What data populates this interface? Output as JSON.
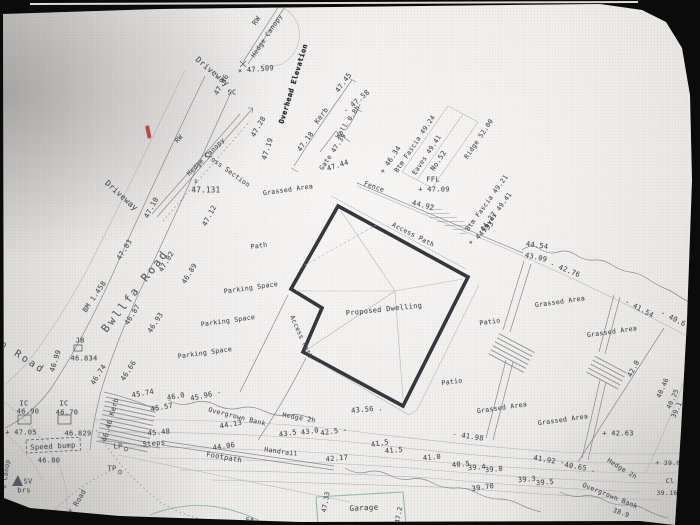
{
  "palette": {
    "background": "#0b0b0b",
    "paper": "#eae8e4",
    "ink": "#4d525a",
    "building_outline": "#34383e",
    "garage_teal": "#84b6ad",
    "pen_mark_red": "#b5332c"
  },
  "plan": {
    "building_label": "Proposed Dwelling",
    "road_name": "Bwllfa Road",
    "labels": [
      {
        "t": "Driveway",
        "x": 212,
        "y": 72,
        "r": 40,
        "s": 8
      },
      {
        "t": "RW",
        "x": 257,
        "y": 21,
        "r": -56,
        "s": 7
      },
      {
        "t": "Hedge Canopy",
        "x": 267,
        "y": 36,
        "r": -56,
        "s": 6.5
      },
      {
        "t": "× 47.509",
        "x": 256,
        "y": 70,
        "r": -5,
        "s": 7
      },
      {
        "t": "47.46",
        "x": 222,
        "y": 85,
        "r": -60,
        "s": 7
      },
      {
        "t": "SC",
        "x": 232,
        "y": 93,
        "r": 0,
        "s": 7
      },
      {
        "t": "Driveway",
        "x": 121,
        "y": 196,
        "r": 42,
        "s": 8
      },
      {
        "t": "47.10",
        "x": 152,
        "y": 208,
        "r": -62,
        "s": 7
      },
      {
        "t": "RW",
        "x": 179,
        "y": 139,
        "r": -48,
        "s": 6.5
      },
      {
        "t": "Hedge Canopy",
        "x": 206,
        "y": 157,
        "r": -45,
        "s": 6.5
      },
      {
        "t": "Cross Section",
        "x": 227,
        "y": 170,
        "r": 36,
        "s": 6.5
      },
      {
        "t": "s",
        "x": 196,
        "y": 182,
        "r": 0,
        "s": 6
      },
      {
        "t": "47.131",
        "x": 206,
        "y": 190,
        "r": 0,
        "s": 7.5
      },
      {
        "t": "47.12",
        "x": 210,
        "y": 216,
        "r": -62,
        "s": 7
      },
      {
        "t": "47.28",
        "x": 259,
        "y": 127,
        "r": -60,
        "s": 7
      },
      {
        "t": "47.19",
        "x": 268,
        "y": 149,
        "r": -72,
        "s": 7
      },
      {
        "t": "Overhead Elevation",
        "x": 294,
        "y": 84,
        "r": -73,
        "s": 7,
        "c": "bold",
        "n": "bold-annotation"
      },
      {
        "t": "47.18",
        "x": 306,
        "y": 142,
        "r": -54,
        "s": 7
      },
      {
        "t": "Kerb",
        "x": 322,
        "y": 116,
        "r": -54,
        "s": 7
      },
      {
        "t": "47.45",
        "x": 344,
        "y": 83,
        "r": -54,
        "s": 7
      },
      {
        "t": "Gate 47.39",
        "x": 333,
        "y": 152,
        "r": -56,
        "s": 6.5
      },
      {
        "t": "Wall 0.8h",
        "x": 348,
        "y": 122,
        "r": -56,
        "s": 6.5
      },
      {
        "t": "- 47.58",
        "x": 357,
        "y": 102,
        "r": -40,
        "s": 7
      },
      {
        "t": "47.44",
        "x": 338,
        "y": 166,
        "r": -18,
        "s": 7
      },
      {
        "t": "Grassed Area",
        "x": 288,
        "y": 190,
        "r": -8,
        "s": 6.5
      },
      {
        "t": "47.03",
        "x": 125,
        "y": 250,
        "r": -58,
        "s": 7
      },
      {
        "t": "47.02",
        "x": 167,
        "y": 262,
        "r": -58,
        "s": 7
      },
      {
        "t": "46.89",
        "x": 190,
        "y": 274,
        "r": -58,
        "s": 7
      },
      {
        "t": "Bwllfa Road",
        "x": 135,
        "y": 291,
        "r": -52,
        "s": 11,
        "c": "big",
        "n": "road-name-bwllfa"
      },
      {
        "t": "BM 1.458",
        "x": 95,
        "y": 297,
        "r": -56,
        "s": 7
      },
      {
        "t": "46.87",
        "x": 133,
        "y": 315,
        "r": -58,
        "s": 7
      },
      {
        "t": "46.93",
        "x": 156,
        "y": 323,
        "r": -58,
        "s": 7
      },
      {
        "t": "p Road",
        "x": 22,
        "y": 358,
        "r": 33,
        "s": 10,
        "c": "big",
        "n": "road-name-fragment"
      },
      {
        "t": "JB",
        "x": 80,
        "y": 341,
        "r": 0,
        "s": 7
      },
      {
        "t": "46.99",
        "x": 56,
        "y": 361,
        "r": -72,
        "s": 7
      },
      {
        "t": "46.834",
        "x": 84,
        "y": 359,
        "r": 0,
        "s": 7
      },
      {
        "t": "46.74",
        "x": 99,
        "y": 375,
        "r": -58,
        "s": 7
      },
      {
        "t": "46.66",
        "x": 129,
        "y": 371,
        "r": -58,
        "s": 7
      },
      {
        "t": "IC",
        "x": 24,
        "y": 404,
        "r": 0,
        "s": 7
      },
      {
        "t": "46.90",
        "x": 28,
        "y": 412,
        "r": 0,
        "s": 7
      },
      {
        "t": "IC",
        "x": 64,
        "y": 404,
        "r": 0,
        "s": 7
      },
      {
        "t": "46.70",
        "x": 67,
        "y": 413,
        "r": 0,
        "s": 7
      },
      {
        "t": "+ 47.05",
        "x": 21,
        "y": 433,
        "r": 0,
        "s": 7
      },
      {
        "t": "46.829",
        "x": 78,
        "y": 434,
        "r": 0,
        "s": 7
      },
      {
        "t": "46.46 Kerb",
        "x": 111,
        "y": 420,
        "r": -74,
        "s": 7
      },
      {
        "t": "Speed bump",
        "x": 53,
        "y": 447,
        "r": -3,
        "s": 7
      },
      {
        "t": "46.80",
        "x": 49,
        "y": 461,
        "r": 0,
        "s": 7
      },
      {
        "t": "LP",
        "x": 118,
        "y": 447,
        "r": 0,
        "s": 7
      },
      {
        "t": "TP",
        "x": 112,
        "y": 469,
        "r": 0,
        "s": 7
      },
      {
        "t": "SV",
        "x": 28,
        "y": 482,
        "r": 0,
        "s": 7
      },
      {
        "t": "brs",
        "x": 24,
        "y": 491,
        "r": 0,
        "s": 7
      },
      {
        "t": "of Road",
        "x": 77,
        "y": 504,
        "r": -60,
        "s": 7
      },
      {
        "t": "e Canop",
        "x": 6,
        "y": 474,
        "r": -82,
        "s": 6.5
      },
      {
        "t": "Path",
        "x": 259,
        "y": 246,
        "r": -8,
        "s": 6.5
      },
      {
        "t": "Parking Space",
        "x": 251,
        "y": 288,
        "r": -8,
        "s": 6.5
      },
      {
        "t": "Parking Space",
        "x": 228,
        "y": 321,
        "r": -8,
        "s": 6.5
      },
      {
        "t": "Parking Space",
        "x": 205,
        "y": 353,
        "r": -8,
        "s": 6.5
      },
      {
        "t": "Access Path",
        "x": 413,
        "y": 235,
        "r": 27,
        "s": 6.5
      },
      {
        "t": "Access Path",
        "x": 301,
        "y": 337,
        "r": 66,
        "s": 6.5
      },
      {
        "t": "Proposed Dwelling",
        "x": 384,
        "y": 310,
        "r": -6,
        "s": 7,
        "n": "proposed-dwelling-label"
      },
      {
        "t": "Fence",
        "x": 374,
        "y": 187,
        "r": 20,
        "s": 6.5
      },
      {
        "t": "+ 46.34",
        "x": 391,
        "y": 160,
        "r": -56,
        "s": 7
      },
      {
        "t": "Btm Fascia 49.24",
        "x": 415,
        "y": 144,
        "r": -56,
        "s": 6.5
      },
      {
        "t": "Eaves 49.41",
        "x": 427,
        "y": 155,
        "r": -56,
        "s": 6.5
      },
      {
        "t": "No.52",
        "x": 439,
        "y": 161,
        "r": -56,
        "s": 7
      },
      {
        "t": "Ridge 52.00",
        "x": 479,
        "y": 139,
        "r": -56,
        "s": 6.5
      },
      {
        "t": "FFL",
        "x": 433,
        "y": 180,
        "r": 0,
        "s": 7
      },
      {
        "t": "+ 47.09",
        "x": 434,
        "y": 190,
        "r": 0,
        "s": 7
      },
      {
        "t": "44.92",
        "x": 423,
        "y": 206,
        "r": 14,
        "s": 7
      },
      {
        "t": "Btm Fascia 49.21",
        "x": 487,
        "y": 203,
        "r": -54,
        "s": 6.5
      },
      {
        "t": "Eaves 49.41",
        "x": 497,
        "y": 212,
        "r": -54,
        "s": 6.5
      },
      {
        "t": "44.27",
        "x": 489,
        "y": 222,
        "r": -54,
        "s": 7
      },
      {
        "t": "* 44.33",
        "x": 482,
        "y": 234,
        "r": -45,
        "s": 7
      },
      {
        "t": "44.54",
        "x": 537,
        "y": 246,
        "r": 8,
        "s": 7
      },
      {
        "t": "43.09",
        "x": 536,
        "y": 258,
        "r": 12,
        "s": 7
      },
      {
        "t": "- 42.76",
        "x": 565,
        "y": 270,
        "r": 22,
        "s": 7
      },
      {
        "t": "- 41.54",
        "x": 639,
        "y": 309,
        "r": 28,
        "s": 7
      },
      {
        "t": "- 40.6",
        "x": 673,
        "y": 319,
        "r": 28,
        "s": 7
      },
      {
        "t": "Grassed Area",
        "x": 560,
        "y": 302,
        "r": -8,
        "s": 6.5
      },
      {
        "t": "Grassed Area",
        "x": 612,
        "y": 332,
        "r": -8,
        "s": 6.5
      },
      {
        "t": "Grassed Area",
        "x": 502,
        "y": 408,
        "r": -8,
        "s": 6.5
      },
      {
        "t": "Grassed Area",
        "x": 563,
        "y": 420,
        "r": -8,
        "s": 6.5
      },
      {
        "t": "Patio",
        "x": 490,
        "y": 322,
        "r": -8,
        "s": 6.5
      },
      {
        "t": "Patio",
        "x": 452,
        "y": 382,
        "r": -8,
        "s": 6.5
      },
      {
        "t": "+ 42.63",
        "x": 618,
        "y": 434,
        "r": 0,
        "s": 7
      },
      {
        "t": "42.0",
        "x": 634,
        "y": 369,
        "r": -62,
        "s": 7
      },
      {
        "t": "40.46",
        "x": 663,
        "y": 388,
        "r": -66,
        "s": 6.5
      },
      {
        "t": "40.25",
        "x": 673,
        "y": 399,
        "r": -66,
        "s": 6.5
      },
      {
        "t": "39.1",
        "x": 677,
        "y": 410,
        "r": -66,
        "s": 6.5
      },
      {
        "t": "+ 39.0",
        "x": 668,
        "y": 463,
        "r": 0,
        "s": 6.5
      },
      {
        "t": "Cl",
        "x": 670,
        "y": 481,
        "r": 0,
        "s": 6.5
      },
      {
        "t": "39.16",
        "x": 667,
        "y": 493,
        "r": 0,
        "s": 6.5
      },
      {
        "t": "Hedge 2h",
        "x": 622,
        "y": 469,
        "r": 32,
        "s": 6.5
      },
      {
        "t": "Overgrown Bank",
        "x": 610,
        "y": 496,
        "r": 22,
        "s": 6.5
      },
      {
        "t": "38.9",
        "x": 621,
        "y": 513,
        "r": 20,
        "s": 6.5
      },
      {
        "t": "43.56 .",
        "x": 367,
        "y": 410,
        "r": -5,
        "s": 7
      },
      {
        "t": "- 41.98",
        "x": 468,
        "y": 437,
        "r": 8,
        "s": 7
      },
      {
        "t": "41.92 -",
        "x": 549,
        "y": 461,
        "r": 10,
        "s": 7
      },
      {
        "t": "40.65 .",
        "x": 580,
        "y": 468,
        "r": 10,
        "s": 7
      },
      {
        "t": "41.5",
        "x": 380,
        "y": 444,
        "r": -10,
        "s": 7
      },
      {
        "t": "41.5",
        "x": 394,
        "y": 451,
        "r": -5,
        "s": 7
      },
      {
        "t": "41.0",
        "x": 432,
        "y": 458,
        "r": -5,
        "s": 7
      },
      {
        "t": "40.5",
        "x": 461,
        "y": 465,
        "r": -5,
        "s": 7
      },
      {
        "t": "39.4",
        "x": 477,
        "y": 468,
        "r": -5,
        "s": 7
      },
      {
        "t": "39.0",
        "x": 494,
        "y": 470,
        "r": -5,
        "s": 7
      },
      {
        "t": "39.70",
        "x": 483,
        "y": 488,
        "r": -8,
        "s": 7
      },
      {
        "t": "39.3",
        "x": 527,
        "y": 480,
        "r": -5,
        "s": 7
      },
      {
        "t": "39.5",
        "x": 545,
        "y": 483,
        "r": -5,
        "s": 7
      },
      {
        "t": "45.74",
        "x": 143,
        "y": 394,
        "r": -10,
        "s": 7
      },
      {
        "t": "46.0",
        "x": 176,
        "y": 397,
        "r": -10,
        "s": 7
      },
      {
        "t": "45.96 -",
        "x": 206,
        "y": 396,
        "r": -12,
        "s": 7
      },
      {
        "t": "45.57",
        "x": 162,
        "y": 408,
        "r": -10,
        "s": 7
      },
      {
        "t": "45.48",
        "x": 159,
        "y": 433,
        "r": -5,
        "s": 7
      },
      {
        "t": "Steps",
        "x": 154,
        "y": 444,
        "r": -5,
        "s": 7
      },
      {
        "t": "Overgrown Bank",
        "x": 237,
        "y": 417,
        "r": 14,
        "s": 6.5
      },
      {
        "t": "44.13",
        "x": 231,
        "y": 425,
        "r": -10,
        "s": 7
      },
      {
        "t": "44.06",
        "x": 224,
        "y": 447,
        "r": -8,
        "s": 7
      },
      {
        "t": "Footpath",
        "x": 224,
        "y": 458,
        "r": 10,
        "s": 7
      },
      {
        "t": "Handrail",
        "x": 281,
        "y": 452,
        "r": 8,
        "s": 6.5
      },
      {
        "t": "Hedge 2h",
        "x": 299,
        "y": 418,
        "r": 10,
        "s": 6.5
      },
      {
        "t": "43.5",
        "x": 288,
        "y": 434,
        "r": -8,
        "s": 7
      },
      {
        "t": "43.0",
        "x": 310,
        "y": 432,
        "r": -8,
        "s": 7
      },
      {
        "t": "42.5 -",
        "x": 334,
        "y": 432,
        "r": -8,
        "s": 7
      },
      {
        "t": "42.17",
        "x": 337,
        "y": 459,
        "r": -5,
        "s": 7
      },
      {
        "t": "Garage",
        "x": 364,
        "y": 508,
        "r": -3,
        "s": 7.5,
        "n": "garage-label"
      },
      {
        "t": "47.33",
        "x": 326,
        "y": 502,
        "r": -80,
        "s": 6.5
      },
      {
        "t": "47.2",
        "x": 399,
        "y": 515,
        "r": -80,
        "s": 6.5
      },
      {
        "t": "Ea",
        "x": 250,
        "y": 520,
        "r": -5,
        "s": 6.5
      }
    ]
  }
}
